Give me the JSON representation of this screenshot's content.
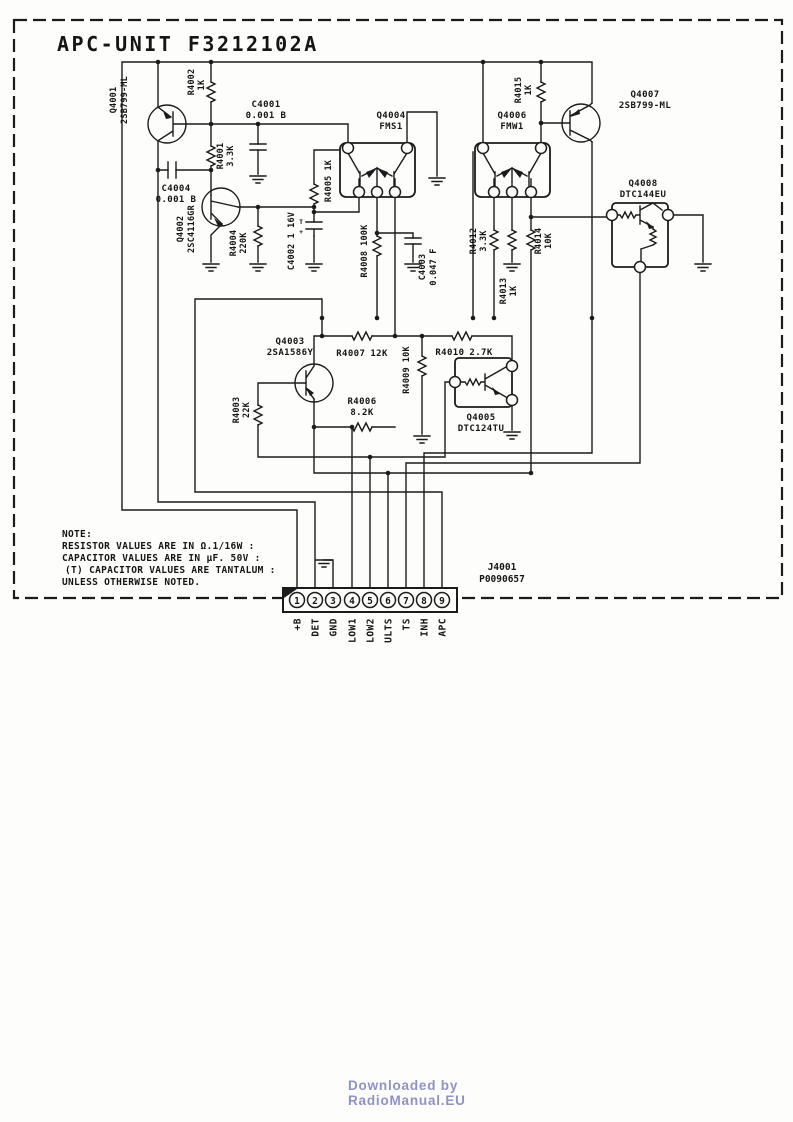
{
  "title": "APC-UNIT F3212102A",
  "components": {
    "q4001": {
      "ref": "Q4001",
      "part": "2SB799-ML"
    },
    "q4002": {
      "ref": "Q4002",
      "part": "2SC4116GR"
    },
    "q4003": {
      "ref": "Q4003",
      "part": "2SA1586Y"
    },
    "q4004": {
      "ref": "Q4004",
      "part": "FMS1"
    },
    "q4005": {
      "ref": "Q4005",
      "part": "DTC124TU"
    },
    "q4006": {
      "ref": "Q4006",
      "part": "FMW1"
    },
    "q4007": {
      "ref": "Q4007",
      "part": "2SB799-ML"
    },
    "q4008": {
      "ref": "Q4008",
      "part": "DTC144EU"
    },
    "r4001": {
      "ref": "R4001",
      "value": "3.3K"
    },
    "r4002": {
      "ref": "R4002",
      "value": "1K"
    },
    "r4003": {
      "ref": "R4003",
      "value": "22K"
    },
    "r4004": {
      "ref": "R4004",
      "value": "220K"
    },
    "r4005": {
      "ref": "R4005",
      "value": "1K"
    },
    "r4006": {
      "ref": "R4006",
      "value": "8.2K"
    },
    "r4007": {
      "ref": "R4007",
      "value": "12K"
    },
    "r4008": {
      "ref": "R4008",
      "value": "100K"
    },
    "r4009": {
      "ref": "R4009",
      "value": "10K"
    },
    "r4010": {
      "ref": "R4010",
      "value": "2.7K"
    },
    "r4012": {
      "ref": "R4012",
      "value": "3.3K"
    },
    "r4013": {
      "ref": "R4013",
      "value": "1K"
    },
    "r4014": {
      "ref": "R4014",
      "value": "10K"
    },
    "r4015": {
      "ref": "R4015",
      "value": "1K"
    },
    "c4001": {
      "ref": "C4001",
      "value": "0.001 B"
    },
    "c4002": {
      "ref": "C4002",
      "value": "1 16V",
      "tantalum_mark": "T",
      "polarity_mark": "+"
    },
    "c4003": {
      "ref": "C4003",
      "value": "0.047 F"
    },
    "c4004": {
      "ref": "C4004",
      "value": "0.001 B"
    }
  },
  "note": {
    "heading": "NOTE:",
    "lines": [
      "RESISTOR  VALUES ARE IN Ω.1/16W :",
      "CAPACITOR VALUES ARE IN µF. 50V :",
      "(T) CAPACITOR VALUES ARE TANTALUM :",
      "UNLESS OTHERWISE NOTED."
    ]
  },
  "connector": {
    "ref": "J4001",
    "part": "P0090657",
    "pins": [
      {
        "num": "1",
        "label": "+B"
      },
      {
        "num": "2",
        "label": "DET"
      },
      {
        "num": "3",
        "label": "GND"
      },
      {
        "num": "4",
        "label": "LOW1"
      },
      {
        "num": "5",
        "label": "LOW2"
      },
      {
        "num": "6",
        "label": "ULTS"
      },
      {
        "num": "7",
        "label": "TS"
      },
      {
        "num": "8",
        "label": "INH"
      },
      {
        "num": "9",
        "label": "APC"
      }
    ]
  },
  "footer": {
    "line1": "Downloaded  by",
    "line2": "RadioManual.EU"
  },
  "colors": {
    "ink": "#1b1b1b",
    "paper": "#fdfdfb",
    "footer_text": "#8f92c4"
  }
}
